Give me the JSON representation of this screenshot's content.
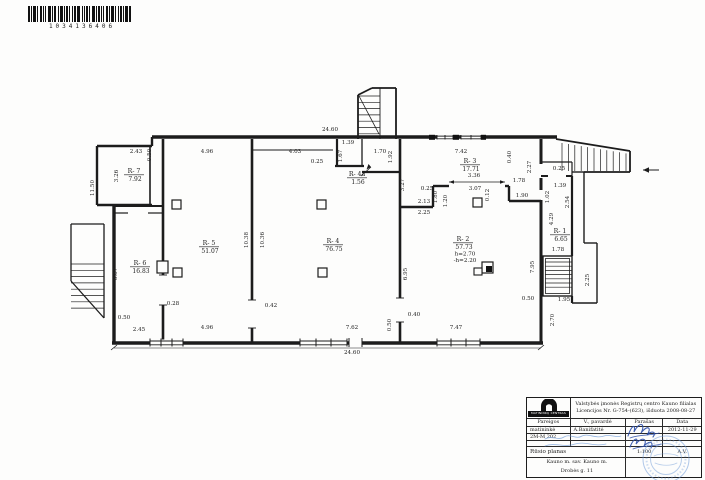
{
  "barcode": {
    "number": "1034136406"
  },
  "plan": {
    "rooms": [
      {
        "name": "R- 7",
        "area": "7.92",
        "x": 134,
        "y": 173
      },
      {
        "name": "R- 6",
        "area": "16.83",
        "x": 140,
        "y": 265
      },
      {
        "name": "R- 5",
        "area": "51.07",
        "x": 209,
        "y": 245
      },
      {
        "name": "R- 4",
        "area": "76.75",
        "x": 333,
        "y": 243
      },
      {
        "name": "R- 4a",
        "area": "1.56",
        "x": 357,
        "y": 176
      },
      {
        "name": "R- 3",
        "area": "17.71",
        "x": 470,
        "y": 163
      },
      {
        "name": "R- 2",
        "area": "57.73",
        "x": 463,
        "y": 241,
        "extra": [
          "h=2.70",
          "-h=2.20"
        ]
      },
      {
        "name": "R- 1",
        "area": "6.65",
        "x": 560,
        "y": 233
      }
    ],
    "dims": [
      {
        "t": "2.43",
        "x": 136,
        "y": 153
      },
      {
        "t": "0.50",
        "x": 151,
        "y": 155,
        "r": 90
      },
      {
        "t": "4.96",
        "x": 207,
        "y": 153
      },
      {
        "t": "4.03",
        "x": 295,
        "y": 153
      },
      {
        "t": "24.60",
        "x": 330,
        "y": 131
      },
      {
        "t": "1.39",
        "x": 348,
        "y": 144
      },
      {
        "t": "1.67",
        "x": 342,
        "y": 156,
        "r": 90
      },
      {
        "t": "0.25",
        "x": 317,
        "y": 163
      },
      {
        "t": "1.70",
        "x": 380,
        "y": 153
      },
      {
        "t": "1.92",
        "x": 392,
        "y": 157,
        "r": 90
      },
      {
        "t": "7.42",
        "x": 461,
        "y": 153
      },
      {
        "t": "0.40",
        "x": 511,
        "y": 157,
        "r": 90
      },
      {
        "t": "2.27",
        "x": 531,
        "y": 167,
        "r": 90
      },
      {
        "t": "3.36",
        "x": 474,
        "y": 177
      },
      {
        "t": "3.07",
        "x": 475,
        "y": 190
      },
      {
        "t": "1.78",
        "x": 519,
        "y": 182
      },
      {
        "t": "1.90",
        "x": 522,
        "y": 197
      },
      {
        "t": "0.12",
        "x": 489,
        "y": 195,
        "r": 90
      },
      {
        "t": "0.25",
        "x": 559,
        "y": 170
      },
      {
        "t": "1.39",
        "x": 560,
        "y": 187
      },
      {
        "t": "1.02",
        "x": 549,
        "y": 197,
        "r": 90
      },
      {
        "t": "2.54",
        "x": 569,
        "y": 202,
        "r": 90
      },
      {
        "t": "4.29",
        "x": 553,
        "y": 219,
        "r": 90
      },
      {
        "t": "3.27",
        "x": 404,
        "y": 185,
        "r": 90
      },
      {
        "t": "0.25",
        "x": 427,
        "y": 190
      },
      {
        "t": "2.13",
        "x": 424,
        "y": 203
      },
      {
        "t": "1.80",
        "x": 437,
        "y": 197,
        "r": 90
      },
      {
        "t": "1.20",
        "x": 447,
        "y": 201,
        "r": 90
      },
      {
        "t": "2.25",
        "x": 424,
        "y": 214
      },
      {
        "t": "11.50",
        "x": 94,
        "y": 188,
        "r": 90
      },
      {
        "t": "3.26",
        "x": 118,
        "y": 176,
        "r": 90
      },
      {
        "t": "6.87",
        "x": 117,
        "y": 274,
        "r": 90
      },
      {
        "t": "0.50",
        "x": 124,
        "y": 319
      },
      {
        "t": "2.45",
        "x": 139,
        "y": 331
      },
      {
        "t": "0.28",
        "x": 173,
        "y": 305
      },
      {
        "t": "4.96",
        "x": 207,
        "y": 329
      },
      {
        "t": "0.42",
        "x": 271,
        "y": 307
      },
      {
        "t": "10.38",
        "x": 248,
        "y": 240,
        "r": 90
      },
      {
        "t": "10.36",
        "x": 264,
        "y": 240,
        "r": 90
      },
      {
        "t": "7.62",
        "x": 352,
        "y": 329
      },
      {
        "t": "0.50",
        "x": 391,
        "y": 325,
        "r": 90
      },
      {
        "t": "24.60",
        "x": 352,
        "y": 354
      },
      {
        "t": "0.40",
        "x": 414,
        "y": 316
      },
      {
        "t": "6.95",
        "x": 407,
        "y": 274,
        "r": 90
      },
      {
        "t": "7.47",
        "x": 456,
        "y": 329
      },
      {
        "t": "7.95",
        "x": 534,
        "y": 267,
        "r": 90
      },
      {
        "t": "1.78",
        "x": 558,
        "y": 251
      },
      {
        "t": "2.25",
        "x": 589,
        "y": 280,
        "r": 90
      },
      {
        "t": "0.50",
        "x": 528,
        "y": 300
      },
      {
        "t": "1.95",
        "x": 564,
        "y": 301
      },
      {
        "t": "2.70",
        "x": 554,
        "y": 320,
        "r": 90
      }
    ]
  },
  "title_block": {
    "logo_text": "MATININKŲ CENTRAS",
    "org_line1": "Valstybės įmonės Registrų centro Kauno filialas",
    "org_line2": "Licencijos Nr. G-754-(623), išduota 2008-08-27",
    "columns": {
      "pareigos": "Pareigos",
      "pavarde": "V., pavardė",
      "parasas": "Parašas",
      "data": "Data"
    },
    "row1": {
      "pareigos": "matininkė",
      "pavarde": "A.Banifatitė",
      "data": "2012-11-29"
    },
    "row2": {
      "code": "2M-M 202"
    },
    "plan_title": "Rūsio planas",
    "scale": "1:100",
    "stamp_label": "A.V.",
    "address_line1": "Kauno m. sav. Kauno m.",
    "address_line2": "Drobės g. 11",
    "ink_color": "#2b4ea8",
    "stamp_color": "#6f9bd8"
  }
}
